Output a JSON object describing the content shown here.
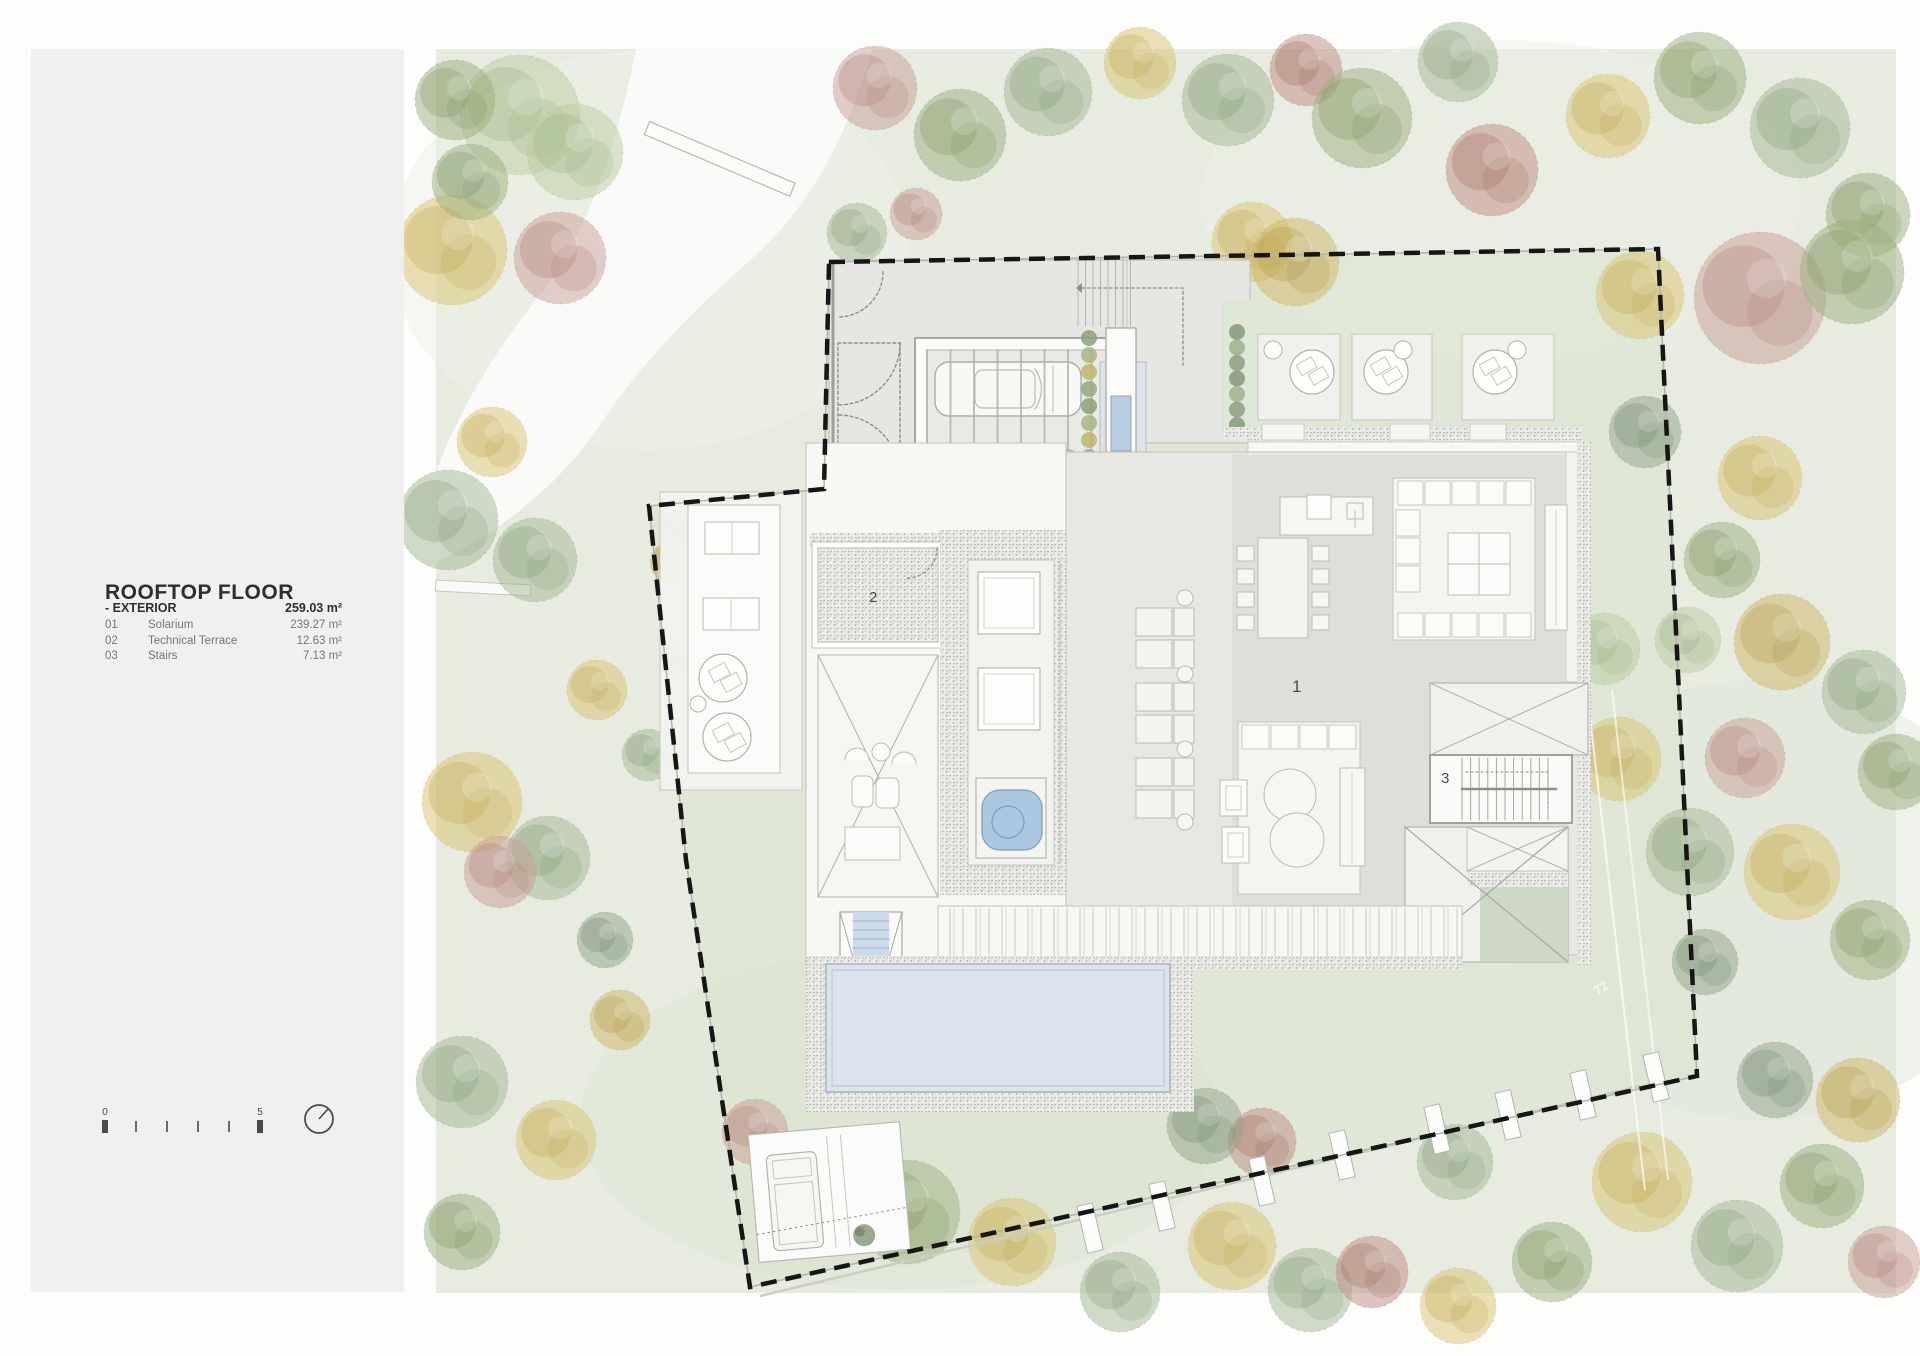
{
  "sidebar": {
    "title": "ROOFTOP FLOOR",
    "section": {
      "label": "- EXTERIOR",
      "value": "259.03 m²"
    },
    "rows": [
      {
        "num": "01",
        "name": "Solarium",
        "value": "239.27 m²"
      },
      {
        "num": "02",
        "name": "Technical Terrace",
        "value": "12.63 m²"
      },
      {
        "num": "03",
        "name": "Stairs",
        "value": "7.13 m²"
      }
    ],
    "scale": {
      "start": "0",
      "end": "5"
    }
  },
  "plan": {
    "labels": {
      "solarium": "1",
      "technical_terrace": "2",
      "stairs": "3",
      "road_marker": "72"
    },
    "colors": {
      "site_bg": "#e7ebe0",
      "lawn": "#dbe4cd",
      "road": "#fafaf8",
      "pool_water": "#dde3ed",
      "jacuzzi": "#abc7e1",
      "skylight": "#b7cde2",
      "panel_gray": "#f0f0ee",
      "boundary": "#161616"
    },
    "palette": {
      "g1": {
        "base": "#a3b795",
        "dark": "#88a078"
      },
      "g2": {
        "base": "#9cb07e",
        "dark": "#829868"
      },
      "g3": {
        "base": "#8fa489",
        "dark": "#768d72"
      },
      "y1": {
        "base": "#d9c36e",
        "dark": "#c0a955"
      },
      "y2": {
        "base": "#cdb662",
        "dark": "#b09a4b"
      },
      "p1": {
        "base": "#c79e95",
        "dark": "#b0837a"
      },
      "p2": {
        "base": "#bd8b81",
        "dark": "#a27065"
      },
      "lg": {
        "base": "#b9cc9f",
        "dark": "#9fb586"
      }
    },
    "trees": [
      [
        520,
        115,
        60,
        "lg"
      ],
      [
        575,
        152,
        48,
        "lg"
      ],
      [
        455,
        100,
        40,
        "g2"
      ],
      [
        452,
        250,
        55,
        "y1"
      ],
      [
        560,
        258,
        46,
        "p1"
      ],
      [
        470,
        182,
        38,
        "g2"
      ],
      [
        448,
        520,
        50,
        "g1"
      ],
      [
        492,
        442,
        35,
        "y1"
      ],
      [
        535,
        560,
        42,
        "g1"
      ],
      [
        875,
        88,
        42,
        "p1"
      ],
      [
        960,
        135,
        46,
        "g2"
      ],
      [
        1048,
        92,
        44,
        "g1"
      ],
      [
        1140,
        63,
        36,
        "y1"
      ],
      [
        1228,
        100,
        46,
        "g1"
      ],
      [
        1306,
        70,
        36,
        "p2"
      ],
      [
        1252,
        242,
        40,
        "y1"
      ],
      [
        1295,
        262,
        44,
        "y2"
      ],
      [
        1362,
        118,
        50,
        "g2"
      ],
      [
        1458,
        62,
        40,
        "g1"
      ],
      [
        1492,
        170,
        46,
        "p2"
      ],
      [
        1608,
        116,
        42,
        "y1"
      ],
      [
        1700,
        78,
        46,
        "g2"
      ],
      [
        1800,
        128,
        50,
        "g1"
      ],
      [
        1868,
        215,
        42,
        "g2"
      ],
      [
        1640,
        295,
        44,
        "y1"
      ],
      [
        1760,
        298,
        66,
        "p1"
      ],
      [
        1852,
        272,
        52,
        "g2"
      ],
      [
        1645,
        432,
        36,
        "g3"
      ],
      [
        1760,
        478,
        42,
        "y1"
      ],
      [
        857,
        233,
        30,
        "g1"
      ],
      [
        916,
        214,
        26,
        "p1"
      ],
      [
        1722,
        560,
        38,
        "g2"
      ],
      [
        1688,
        640,
        33,
        "lg"
      ],
      [
        1782,
        642,
        48,
        "y2"
      ],
      [
        1864,
        692,
        42,
        "g1"
      ],
      [
        1896,
        772,
        38,
        "g2"
      ],
      [
        1745,
        758,
        40,
        "p1"
      ],
      [
        1619,
        759,
        42,
        "y1"
      ],
      [
        1604,
        649,
        36,
        "lg"
      ],
      [
        1690,
        852,
        44,
        "g1"
      ],
      [
        1792,
        872,
        48,
        "y1"
      ],
      [
        1870,
        940,
        40,
        "g2"
      ],
      [
        1705,
        962,
        33,
        "g3"
      ],
      [
        1642,
        1182,
        50,
        "y1"
      ],
      [
        1737,
        1246,
        46,
        "g1"
      ],
      [
        1822,
        1186,
        42,
        "g2"
      ],
      [
        1884,
        1262,
        36,
        "p1"
      ],
      [
        1552,
        1262,
        40,
        "g2"
      ],
      [
        1458,
        1306,
        38,
        "y1"
      ],
      [
        1775,
        1080,
        38,
        "g3"
      ],
      [
        1858,
        1100,
        42,
        "y2"
      ],
      [
        1232,
        1246,
        44,
        "y1"
      ],
      [
        1262,
        1142,
        34,
        "p2"
      ],
      [
        1205,
        1126,
        38,
        "g3"
      ],
      [
        1310,
        1290,
        42,
        "g1"
      ],
      [
        1372,
        1272,
        36,
        "p2"
      ],
      [
        1455,
        1162,
        38,
        "g1"
      ],
      [
        908,
        1212,
        52,
        "g2"
      ],
      [
        1012,
        1242,
        44,
        "y1"
      ],
      [
        1120,
        1292,
        40,
        "g1"
      ],
      [
        755,
        1132,
        33,
        "p1"
      ],
      [
        472,
        802,
        50,
        "y1"
      ],
      [
        548,
        858,
        42,
        "g1"
      ],
      [
        500,
        872,
        36,
        "p1"
      ],
      [
        462,
        1082,
        46,
        "g1"
      ],
      [
        556,
        1140,
        40,
        "y1"
      ],
      [
        462,
        1232,
        38,
        "g2"
      ],
      [
        620,
        1020,
        30,
        "y2"
      ],
      [
        605,
        940,
        28,
        "g3"
      ],
      [
        597,
        690,
        30,
        "y1"
      ],
      [
        648,
        755,
        26,
        "g1"
      ],
      [
        678,
        528,
        18,
        "g3"
      ],
      [
        670,
        562,
        20,
        "y2"
      ],
      [
        680,
        660,
        20,
        "p2"
      ]
    ],
    "parking_markers": [
      [
        1090,
        1228
      ],
      [
        1162,
        1206
      ],
      [
        1262,
        1181
      ],
      [
        1342,
        1155
      ],
      [
        1437,
        1129
      ],
      [
        1508,
        1115
      ],
      [
        1583,
        1095
      ],
      [
        1656,
        1077
      ]
    ],
    "lounger_rows": [
      608,
      640,
      683,
      715,
      758,
      790
    ],
    "lounger_tables": [
      598,
      674,
      749,
      822
    ]
  }
}
